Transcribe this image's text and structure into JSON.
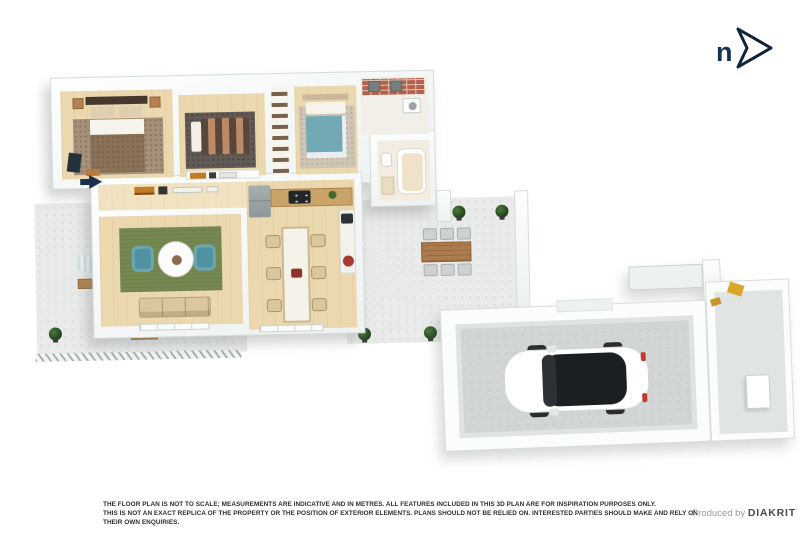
{
  "compass": {
    "label": "n",
    "color": "#16324f"
  },
  "disclaimer": {
    "line1": "THE FLOOR PLAN IS NOT TO SCALE; MEASUREMENTS ARE INDICATIVE AND IN METRES. ALL FEATURES INCLUDED IN THIS 3D PLAN ARE FOR INSPIRATION PURPOSES ONLY.",
    "line2": "THIS IS NOT AN EXACT REPLICA OF THE PROPERTY OR THE POSITION OF EXTERIOR ELEMENTS. PLANS SHOULD NOT BE RELIED ON. INTERESTED PARTIES SHOULD MAKE AND RELY ON THEIR OWN ENQUIRIES.",
    "credit_prefix": "Produced by ",
    "credit_brand": "DIAKRIT"
  },
  "floorplan": {
    "type": "3d-isometric-floor-plan",
    "north_arrow_direction": "right",
    "entry_arrow_direction": "right",
    "rooms": [
      {
        "name": "master-bedroom",
        "floor": "timber",
        "key_items": [
          "double-bed",
          "speckled-rug",
          "nightstands",
          "bench"
        ]
      },
      {
        "name": "bedroom-2",
        "floor": "timber",
        "key_items": [
          "striped-double-bed",
          "dark-rug",
          "bookshelf"
        ]
      },
      {
        "name": "wardrobe",
        "floor": "timber",
        "key_items": [
          "hanging-clothes"
        ]
      },
      {
        "name": "bedroom-3",
        "floor": "timber",
        "key_items": [
          "teal-double-bed",
          "light-rug"
        ]
      },
      {
        "name": "laundry",
        "floor": "tile",
        "key_items": [
          "brick-bench",
          "twin-sinks",
          "washing-machine"
        ]
      },
      {
        "name": "bathroom",
        "floor": "tile",
        "key_items": [
          "bathtub",
          "toilet",
          "vanity"
        ]
      },
      {
        "name": "hallway",
        "floor": "timber",
        "key_items": [
          "console-shelf"
        ]
      },
      {
        "name": "living-room",
        "floor": "timber",
        "key_items": [
          "green-rug",
          "round-table",
          "teal-armchairs-x2",
          "sofa"
        ]
      },
      {
        "name": "kitchen-dining",
        "floor": "timber",
        "key_items": [
          "fridge",
          "cooktop",
          "timber-bench",
          "long-dining-table",
          "dining-chairs-x6",
          "fruit-bowl"
        ]
      },
      {
        "name": "side-patio",
        "floor": "concrete",
        "key_items": [
          "lounge-chairs-x2",
          "timber-coffee-table",
          "potted-plants"
        ]
      },
      {
        "name": "courtyard-patio",
        "floor": "concrete",
        "key_items": [
          "outdoor-dining-table",
          "outdoor-chairs-x6",
          "potted-plants"
        ]
      },
      {
        "name": "garage",
        "floor": "concrete",
        "key_items": [
          "white-car"
        ]
      },
      {
        "name": "storage-room",
        "floor": "concrete",
        "key_items": [
          "white-cabinet",
          "garden-tools"
        ]
      }
    ],
    "colors": {
      "timber_floor": "#ecd8ae",
      "hall_floor": "#f1e3c2",
      "concrete_patio": "#e9eaea",
      "garage_floor": "#d2d5d5",
      "wall": "#f6f8f8",
      "rug_green": "#75884f",
      "armchair_teal": "#4f93a2",
      "bed_teal": "#73a9b4",
      "bed_brown": "#8a7158",
      "outdoor_table_wood": "#ad7c4e",
      "entry_arrow_navy": "#18304d",
      "car_body": "#ffffff",
      "car_glass": "#1c1f22"
    }
  }
}
